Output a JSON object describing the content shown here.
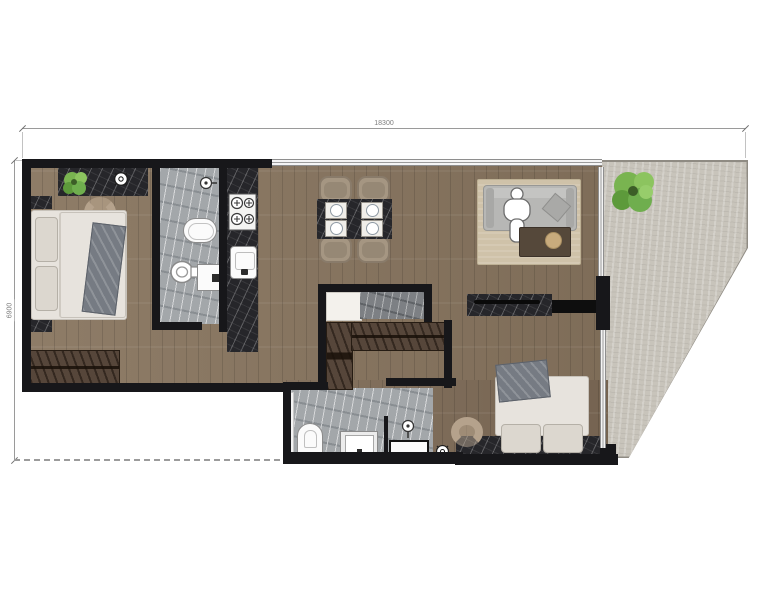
{
  "dimensions": {
    "top_label": "18300",
    "left_label": "6900"
  },
  "palette": {
    "wall": "#17171a",
    "wood_floor": "#7e6b57",
    "bathroom_marble": "#a3a7aa",
    "dark_marble_counter": "#26262a",
    "terrace_concrete": "#c8c4bb",
    "rug": "#cfc2a9",
    "sofa_gray": "#b7b7b5",
    "chair_tan": "#b5a28c",
    "plant_green": "#6fae4e",
    "background": "#ffffff"
  }
}
